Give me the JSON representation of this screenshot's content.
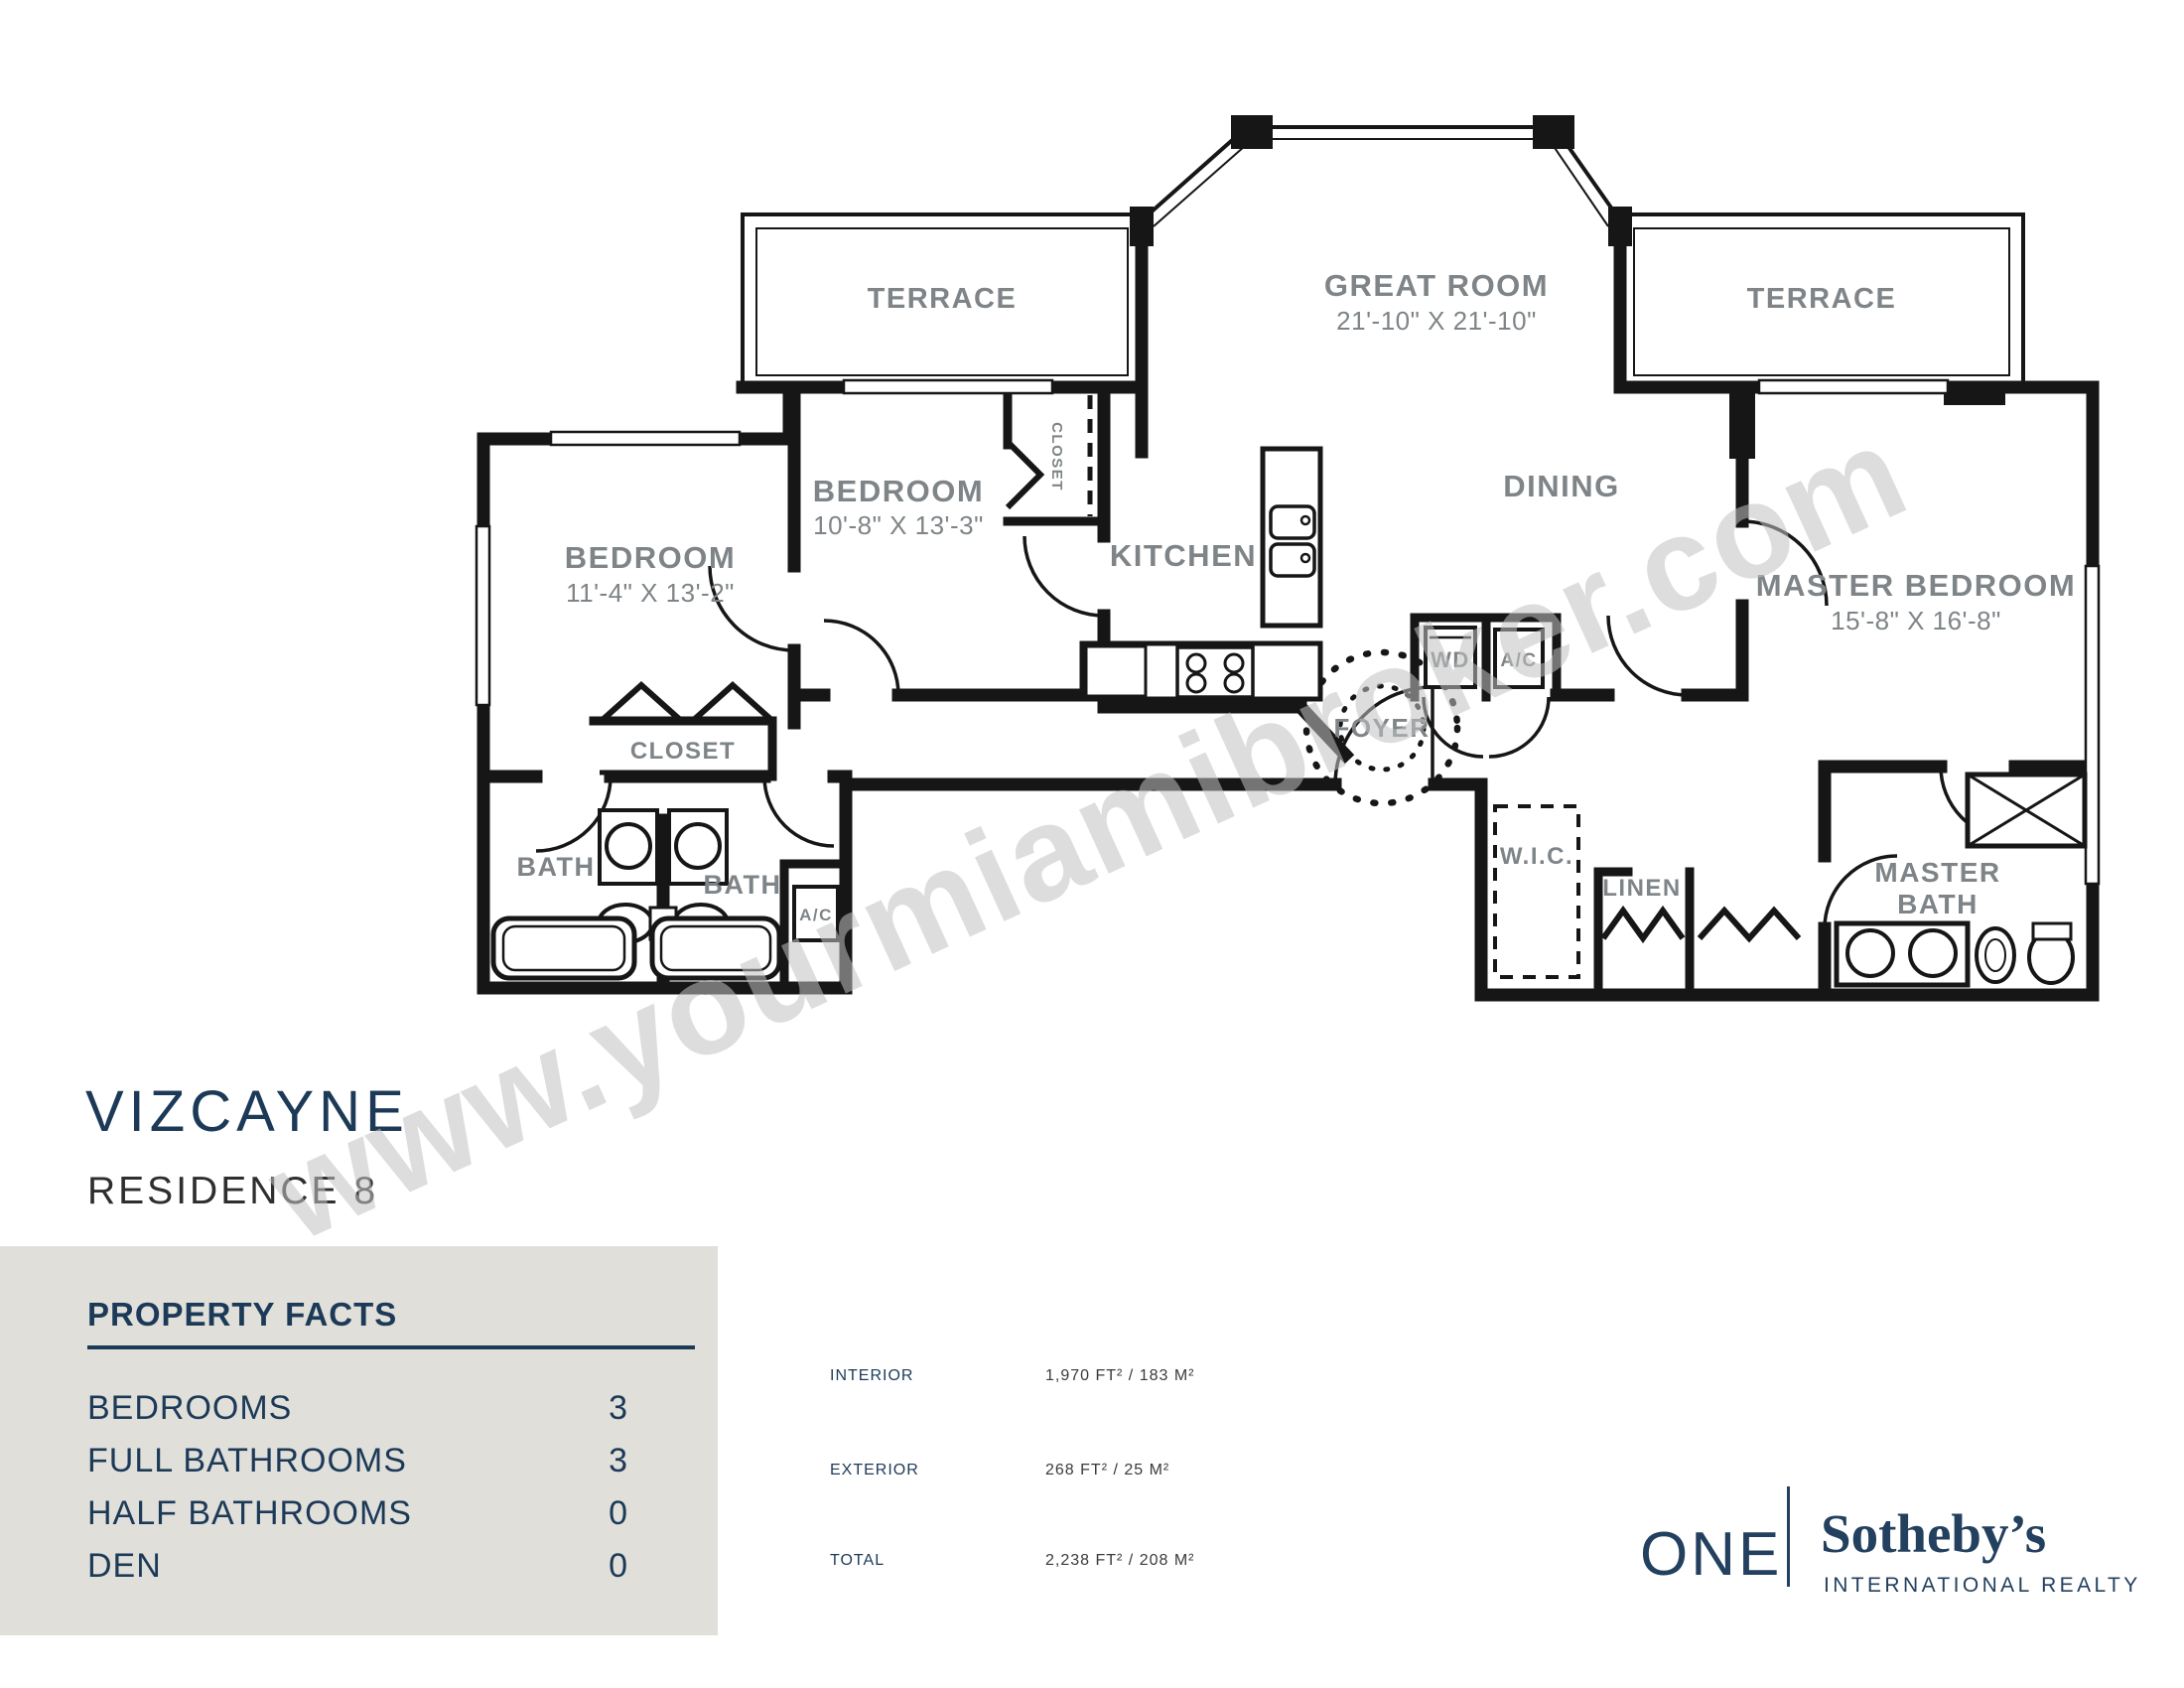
{
  "watermark": "www.yourmiamibroker.com",
  "title": {
    "building": "VIZCAYNE",
    "residence": "RESIDENCE 8"
  },
  "property_facts": {
    "heading": "PROPERTY FACTS",
    "rows": [
      {
        "label": "BEDROOMS",
        "value": "3"
      },
      {
        "label": "FULL BATHROOMS",
        "value": "3"
      },
      {
        "label": "HALF BATHROOMS",
        "value": "0"
      },
      {
        "label": "DEN",
        "value": "0"
      }
    ]
  },
  "areas": {
    "rows": [
      {
        "label": "INTERIOR",
        "value": "1,970 FT² / 183 M²"
      },
      {
        "label": "EXTERIOR",
        "value": "268 FT² / 25 M²"
      },
      {
        "label": "TOTAL",
        "value": "2,238 FT² / 208 M²"
      }
    ]
  },
  "logo": {
    "one": "ONE",
    "brand": "Sotheby’s",
    "sub": "INTERNATIONAL REALTY"
  },
  "floor_plan": {
    "rooms": {
      "terrace_left": {
        "label": "TERRACE"
      },
      "great_room": {
        "label": "GREAT ROOM",
        "dims": "21'-10\" X 21'-10\""
      },
      "terrace_right": {
        "label": "TERRACE"
      },
      "bedroom_left": {
        "label": "BEDROOM",
        "dims": "11'-4\" X 13'-2\""
      },
      "bedroom_mid": {
        "label": "BEDROOM",
        "dims": "10'-8\" X 13'-3\""
      },
      "kitchen": {
        "label": "KITCHEN"
      },
      "dining": {
        "label": "DINING"
      },
      "master_bedroom": {
        "label": "MASTER BEDROOM",
        "dims": "15'-8\" X 16'-8\""
      },
      "foyer": {
        "label": "FOYER"
      },
      "closet_bedroom": {
        "label": "CLOSET"
      },
      "closet_hall": {
        "label": "CLOSET"
      },
      "bath_1": {
        "label": "BATH"
      },
      "bath_2": {
        "label": "BATH"
      },
      "ac_closet_1": {
        "label": "A/C"
      },
      "washer_dryer": {
        "label": "WD"
      },
      "ac_closet_2": {
        "label": "A/C"
      },
      "wic": {
        "label": "W.I.C."
      },
      "linen": {
        "label": "LINEN"
      },
      "master_bath": {
        "line1": "MASTER",
        "line2": "BATH"
      }
    }
  },
  "colors": {
    "navy": "#1c3a57",
    "label_gray": "#7e8487",
    "panel": "#e0dfda",
    "wall": "#161616",
    "watermark": "#c2c2c2"
  }
}
